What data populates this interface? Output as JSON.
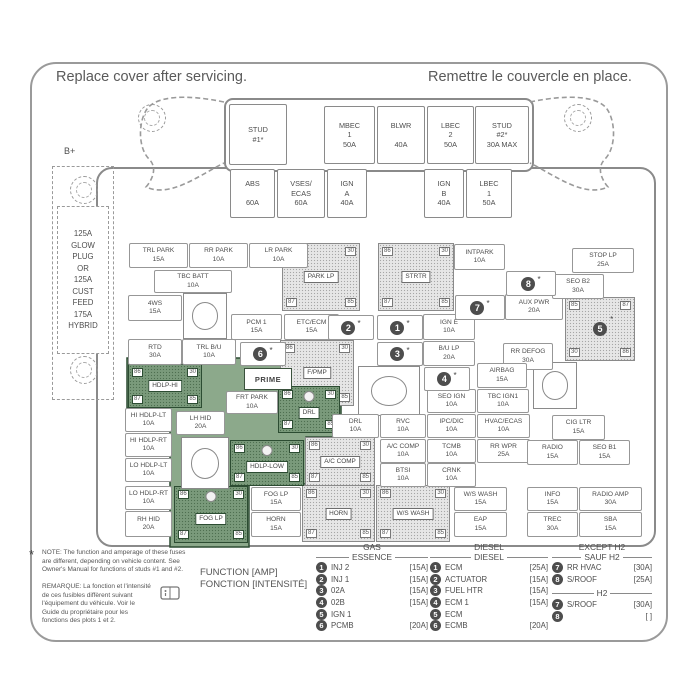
{
  "header": {
    "en": "Replace cover after servicing.",
    "fr": "Remettre le couvercle en place."
  },
  "colors": {
    "green_fill": "#8ca98b",
    "green_relay": "#7a9a7b",
    "green_border": "#2c4c32",
    "gray_border": "#8a8a8a",
    "callout_circle": "#4d4d4d",
    "text": "#4d4d4d"
  },
  "b_plus_label": "B+",
  "glow_plug_text": "125A\nGLOW\nPLUG\nOR\n125A\nCUST\nFEED\n175A\nHYBRID",
  "prime_label": "PRIME",
  "top_row": [
    {
      "label": "STUD\n#1*",
      "x": 229,
      "y": 104,
      "w": 56,
      "h": 59
    },
    {
      "label": "MBEC\n1\n50A",
      "x": 324,
      "y": 106,
      "w": 49,
      "h": 56
    },
    {
      "label": "BLWR\n\n40A",
      "x": 377,
      "y": 106,
      "w": 46,
      "h": 56
    },
    {
      "label": "LBEC\n2\n50A",
      "x": 427,
      "y": 106,
      "w": 45,
      "h": 56
    },
    {
      "label": "STUD\n#2*\n30A MAX",
      "x": 475,
      "y": 106,
      "w": 52,
      "h": 56
    }
  ],
  "second_row": [
    {
      "label": "ABS\n\n60A",
      "x": 230,
      "y": 169,
      "w": 43,
      "h": 47
    },
    {
      "label": "VSES/\nECAS\n60A",
      "x": 277,
      "y": 169,
      "w": 46,
      "h": 47
    },
    {
      "label": "IGN\nA\n40A",
      "x": 327,
      "y": 169,
      "w": 38,
      "h": 47
    },
    {
      "label": "IGN\nB\n40A",
      "x": 424,
      "y": 169,
      "w": 38,
      "h": 47
    },
    {
      "label": "LBEC\n1\n50A",
      "x": 466,
      "y": 169,
      "w": 44,
      "h": 47
    }
  ],
  "fuses": [
    {
      "n": "TRL PARK",
      "a": "15A",
      "x": 129,
      "y": 243,
      "w": 57,
      "h": 23
    },
    {
      "n": "RR PARK",
      "a": "10A",
      "x": 189,
      "y": 243,
      "w": 57,
      "h": 23
    },
    {
      "n": "LR PARK",
      "a": "10A",
      "x": 249,
      "y": 243,
      "w": 57,
      "h": 23
    },
    {
      "n": "TBC BATT",
      "a": "10A",
      "x": 154,
      "y": 270,
      "w": 76,
      "h": 21
    },
    {
      "n": "4WS",
      "a": "15A",
      "x": 128,
      "y": 295,
      "w": 52,
      "h": 24
    },
    {
      "n": "RTD",
      "a": "30A",
      "x": 128,
      "y": 339,
      "w": 52,
      "h": 24
    },
    {
      "n": "TRL B/U",
      "a": "10A",
      "x": 182,
      "y": 339,
      "w": 52,
      "h": 24
    },
    {
      "n": "PCM 1",
      "a": "15A",
      "x": 231,
      "y": 314,
      "w": 49,
      "h": 24
    },
    {
      "n": "ETC/ECM",
      "a": "15A",
      "x": 284,
      "y": 314,
      "w": 53,
      "h": 24
    },
    {
      "n": "IGN E",
      "a": "10A",
      "x": 423,
      "y": 314,
      "w": 50,
      "h": 24
    },
    {
      "n": "B/U LP",
      "a": "20A",
      "x": 423,
      "y": 341,
      "w": 50,
      "h": 23
    },
    {
      "n": "INTPARK",
      "a": "10A",
      "x": 454,
      "y": 244,
      "w": 49,
      "h": 24
    },
    {
      "n": "AUX PWR",
      "a": "20A",
      "x": 505,
      "y": 294,
      "w": 56,
      "h": 24
    },
    {
      "n": "STOP LP",
      "a": "25A",
      "x": 572,
      "y": 248,
      "w": 60,
      "h": 23
    },
    {
      "n": "SEO B2",
      "a": "30A",
      "x": 552,
      "y": 274,
      "w": 50,
      "h": 23
    },
    {
      "n": "RR DEFOG",
      "a": "30A",
      "x": 503,
      "y": 343,
      "w": 48,
      "h": 25
    },
    {
      "n": "AIRBAG",
      "a": "15A",
      "x": 477,
      "y": 363,
      "w": 48,
      "h": 23
    },
    {
      "n": "TBC IGN1",
      "a": "10A",
      "x": 477,
      "y": 389,
      "w": 50,
      "h": 22
    },
    {
      "n": "SEO IGN",
      "a": "10A",
      "x": 427,
      "y": 389,
      "w": 47,
      "h": 22
    },
    {
      "n": "FRT PARK",
      "a": "10A",
      "x": 226,
      "y": 391,
      "w": 50,
      "h": 21
    },
    {
      "n": "HI HDLP-LT",
      "a": "10A",
      "x": 125,
      "y": 408,
      "w": 45,
      "h": 22
    },
    {
      "n": "LH HID",
      "a": "20A",
      "x": 176,
      "y": 411,
      "w": 47,
      "h": 22
    },
    {
      "n": "HI HDLP-RT",
      "a": "10A",
      "x": 125,
      "y": 433,
      "w": 45,
      "h": 22
    },
    {
      "n": "LO HDLP-LT",
      "a": "10A",
      "x": 125,
      "y": 458,
      "w": 45,
      "h": 22
    },
    {
      "n": "LO HDLP-RT",
      "a": "10A",
      "x": 125,
      "y": 486,
      "w": 45,
      "h": 22
    },
    {
      "n": "RH HID",
      "a": "20A",
      "x": 125,
      "y": 511,
      "w": 45,
      "h": 24
    },
    {
      "n": "DRL",
      "a": "10A",
      "x": 332,
      "y": 414,
      "w": 45,
      "h": 22
    },
    {
      "n": "RVC",
      "a": "10A",
      "x": 380,
      "y": 414,
      "w": 44,
      "h": 22
    },
    {
      "n": "IPC/DIC",
      "a": "10A",
      "x": 427,
      "y": 414,
      "w": 47,
      "h": 22
    },
    {
      "n": "HVAC/ECAS",
      "a": "10A",
      "x": 477,
      "y": 414,
      "w": 51,
      "h": 22
    },
    {
      "n": "A/C COMP",
      "a": "10A",
      "x": 380,
      "y": 439,
      "w": 44,
      "h": 22
    },
    {
      "n": "TCMB",
      "a": "10A",
      "x": 427,
      "y": 439,
      "w": 47,
      "h": 22
    },
    {
      "n": "RR WPR",
      "a": "25A",
      "x": 477,
      "y": 439,
      "w": 51,
      "h": 22
    },
    {
      "n": "BTSI",
      "a": "10A",
      "x": 380,
      "y": 463,
      "w": 44,
      "h": 22
    },
    {
      "n": "CRNK",
      "a": "10A",
      "x": 427,
      "y": 463,
      "w": 47,
      "h": 22
    },
    {
      "n": "CIG LTR",
      "a": "15A",
      "x": 552,
      "y": 415,
      "w": 51,
      "h": 23
    },
    {
      "n": "RADIO",
      "a": "15A",
      "x": 527,
      "y": 440,
      "w": 49,
      "h": 23
    },
    {
      "n": "SEO B1",
      "a": "15A",
      "x": 579,
      "y": 440,
      "w": 49,
      "h": 23
    },
    {
      "n": "FOG LP",
      "a": "15A",
      "x": 251,
      "y": 487,
      "w": 48,
      "h": 22
    },
    {
      "n": "HORN",
      "a": "15A",
      "x": 251,
      "y": 512,
      "w": 48,
      "h": 23
    },
    {
      "n": "W/S WASH",
      "a": "15A",
      "x": 454,
      "y": 487,
      "w": 51,
      "h": 22
    },
    {
      "n": "EAP",
      "a": "15A",
      "x": 454,
      "y": 512,
      "w": 51,
      "h": 23
    },
    {
      "n": "INFO",
      "a": "15A",
      "x": 527,
      "y": 487,
      "w": 49,
      "h": 22
    },
    {
      "n": "RADIO AMP",
      "a": "30A",
      "x": 579,
      "y": 487,
      "w": 61,
      "h": 22
    },
    {
      "n": "TREC",
      "a": "30A",
      "x": 527,
      "y": 512,
      "w": 49,
      "h": 23
    },
    {
      "n": "SBA",
      "a": "15A",
      "x": 579,
      "y": 512,
      "w": 61,
      "h": 23
    }
  ],
  "relays": [
    {
      "label": "PARK LP",
      "pins": [
        "86",
        "30",
        "87",
        "85"
      ],
      "x": 282,
      "y": 243,
      "w": 76,
      "h": 66,
      "v": "gray"
    },
    {
      "label": "STRTR",
      "pins": [
        "86",
        "30",
        "87",
        "85"
      ],
      "x": 378,
      "y": 243,
      "w": 74,
      "h": 66,
      "v": "gray"
    },
    {
      "label": "F/PMP",
      "pins": [
        "86",
        "30",
        "87",
        "85"
      ],
      "x": 280,
      "y": 340,
      "w": 72,
      "h": 64,
      "v": "gray"
    },
    {
      "label": "A/C COMP",
      "pins": [
        "86",
        "30",
        "87",
        "85"
      ],
      "x": 305,
      "y": 437,
      "w": 68,
      "h": 47,
      "v": "gray"
    },
    {
      "label": "HORN",
      "pins": [
        "86",
        "30",
        "87",
        "85"
      ],
      "x": 302,
      "y": 485,
      "w": 71,
      "h": 55,
      "v": "gray"
    },
    {
      "label": "W/S WASH",
      "pins": [
        "86",
        "30",
        "87",
        "85"
      ],
      "x": 376,
      "y": 485,
      "w": 72,
      "h": 55,
      "v": "gray"
    },
    {
      "label": "HDLP-HI",
      "pins": [
        "86",
        "30",
        "87",
        "85"
      ],
      "x": 128,
      "y": 364,
      "w": 72,
      "h": 42,
      "v": "green"
    },
    {
      "label": "DRL",
      "pins": [
        "86",
        "30",
        "87",
        "85"
      ],
      "x": 278,
      "y": 386,
      "w": 60,
      "h": 45,
      "v": "green",
      "dot": true
    },
    {
      "label": "HDLP-LOW",
      "pins": [
        "86",
        "30",
        "87",
        "85"
      ],
      "x": 230,
      "y": 440,
      "w": 72,
      "h": 44,
      "v": "green",
      "dot": true
    },
    {
      "label": "FOG LP",
      "pins": [
        "86",
        "30",
        "87",
        "85"
      ],
      "x": 174,
      "y": 486,
      "w": 72,
      "h": 55,
      "v": "green",
      "dot": true
    },
    {
      "label": "",
      "pins": [
        "85",
        "87",
        "30",
        "86"
      ],
      "x": 565,
      "y": 297,
      "w": 68,
      "h": 62,
      "v": "gray",
      "callout": "5"
    }
  ],
  "relay_squares": [
    {
      "x": 183,
      "y": 293,
      "w": 42,
      "h": 44
    },
    {
      "x": 358,
      "y": 366,
      "w": 60,
      "h": 48
    },
    {
      "x": 533,
      "y": 362,
      "w": 42,
      "h": 45
    },
    {
      "x": 181,
      "y": 437,
      "w": 46,
      "h": 50
    }
  ],
  "callouts": [
    {
      "n": "6",
      "x": 240,
      "y": 342,
      "w": 44,
      "h": 22
    },
    {
      "n": "2",
      "x": 328,
      "y": 315,
      "w": 44,
      "h": 23
    },
    {
      "n": "1",
      "x": 377,
      "y": 315,
      "w": 44,
      "h": 23
    },
    {
      "n": "3",
      "x": 377,
      "y": 342,
      "w": 44,
      "h": 22
    },
    {
      "n": "4",
      "x": 424,
      "y": 367,
      "w": 44,
      "h": 22
    },
    {
      "n": "7",
      "x": 455,
      "y": 295,
      "w": 48,
      "h": 23
    },
    {
      "n": "8",
      "x": 506,
      "y": 271,
      "w": 48,
      "h": 23
    }
  ],
  "note": {
    "star": "*",
    "en": "NOTE:  The function and amperage of these fuses are different, depending on vehicle content. See Owner's Manual for functions of studs #1 and #2.",
    "fr": "REMARQUE:  La fonction et l'intensité de ces fusibles diffèrent suivant l'équipement du véhicule. Voir le Guide du propriétaire pour les fonctions des plots 1 et 2."
  },
  "function_label": {
    "en": "FUNCTION [AMP]",
    "fr": "FONCTION [INTENSITÉ]"
  },
  "legend": {
    "columns": [
      {
        "id": "gas",
        "x": 316,
        "y": 543,
        "w": 112,
        "sections": [
          {
            "title_lines": [
              "GAS",
              "ESSENCE"
            ],
            "items": [
              {
                "n": "1",
                "label": "INJ 2",
                "amp": "[15A]"
              },
              {
                "n": "2",
                "label": "INJ 1",
                "amp": "[15A]"
              },
              {
                "n": "3",
                "label": "02A",
                "amp": "[15A]"
              },
              {
                "n": "4",
                "label": "02B",
                "amp": "[15A]"
              },
              {
                "n": "5",
                "label": "IGN 1",
                "amp": ""
              },
              {
                "n": "6",
                "label": "PCMB",
                "amp": "[20A]"
              }
            ]
          }
        ]
      },
      {
        "id": "diesel",
        "x": 430,
        "y": 543,
        "w": 118,
        "sections": [
          {
            "title_lines": [
              "DIESEL",
              "DIESEL"
            ],
            "items": [
              {
                "n": "1",
                "label": "ECM",
                "amp": "[25A]"
              },
              {
                "n": "2",
                "label": "ACTUATOR",
                "amp": "[15A]"
              },
              {
                "n": "3",
                "label": "FUEL HTR",
                "amp": "[15A]"
              },
              {
                "n": "4",
                "label": "ECM 1",
                "amp": "[15A]"
              },
              {
                "n": "5",
                "label": "ECM",
                "amp": ""
              },
              {
                "n": "6",
                "label": "ECMB",
                "amp": "[20A]"
              }
            ]
          }
        ]
      },
      {
        "id": "h2",
        "x": 552,
        "y": 543,
        "w": 100,
        "sections": [
          {
            "title_lines": [
              "EXCEPT H2",
              "SAUF H2"
            ],
            "items": [
              {
                "n": "7",
                "label": "RR HVAC",
                "amp": "[30A]"
              },
              {
                "n": "8",
                "label": "S/ROOF",
                "amp": "[25A]"
              }
            ]
          },
          {
            "title_lines": [
              "H2"
            ],
            "items": [
              {
                "n": "7",
                "label": "S/ROOF",
                "amp": "[30A]"
              },
              {
                "n": "8",
                "label": "",
                "amp": "[    ]"
              }
            ]
          }
        ]
      }
    ]
  }
}
